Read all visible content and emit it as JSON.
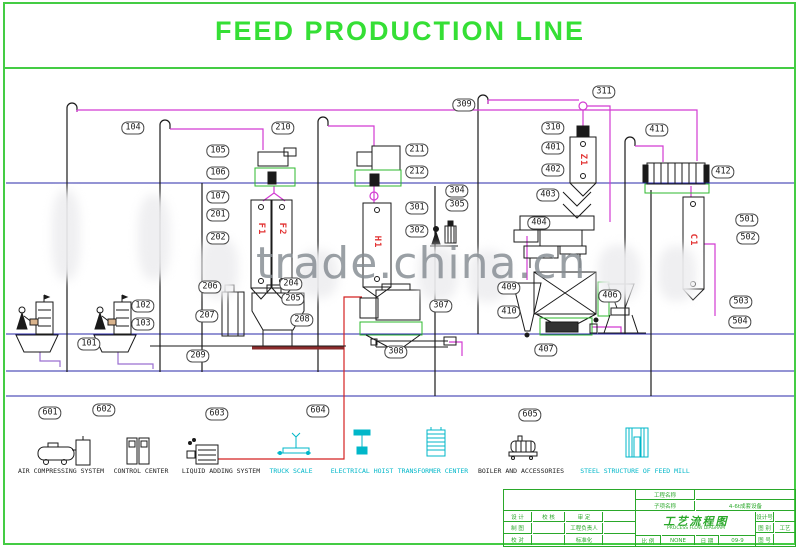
{
  "title": "FEED PRODUCTION LINE",
  "watermark": "trade.china.cn",
  "colors": {
    "border_green": "#44cc44",
    "equipment_green": "#2db82d",
    "flow_magenta": "#d23bd2",
    "liquid_red": "#d42222",
    "floor_navy": "#2a2aa8",
    "cyan_items": "#00b7c9",
    "bin_tag_red": "#e23434",
    "title_green": "#35df35",
    "titleblock_green": "#2aa82a"
  },
  "labels": [
    {
      "t": "101",
      "x": 89,
      "y": 344
    },
    {
      "t": "102",
      "x": 143,
      "y": 306
    },
    {
      "t": "103",
      "x": 143,
      "y": 324
    },
    {
      "t": "104",
      "x": 133,
      "y": 128
    },
    {
      "t": "105",
      "x": 218,
      "y": 151
    },
    {
      "t": "106",
      "x": 218,
      "y": 173
    },
    {
      "t": "107",
      "x": 218,
      "y": 197
    },
    {
      "t": "201",
      "x": 218,
      "y": 215
    },
    {
      "t": "202",
      "x": 218,
      "y": 238
    },
    {
      "t": "204",
      "x": 291,
      "y": 284
    },
    {
      "t": "205",
      "x": 293,
      "y": 299
    },
    {
      "t": "206",
      "x": 210,
      "y": 287
    },
    {
      "t": "207",
      "x": 207,
      "y": 316
    },
    {
      "t": "208",
      "x": 302,
      "y": 320
    },
    {
      "t": "209",
      "x": 198,
      "y": 356
    },
    {
      "t": "210",
      "x": 283,
      "y": 128
    },
    {
      "t": "211",
      "x": 417,
      "y": 150
    },
    {
      "t": "212",
      "x": 417,
      "y": 172
    },
    {
      "t": "301",
      "x": 417,
      "y": 208
    },
    {
      "t": "302",
      "x": 417,
      "y": 231
    },
    {
      "t": "304",
      "x": 457,
      "y": 191
    },
    {
      "t": "305",
      "x": 457,
      "y": 205
    },
    {
      "t": "307",
      "x": 441,
      "y": 306
    },
    {
      "t": "308",
      "x": 396,
      "y": 352
    },
    {
      "t": "309",
      "x": 464,
      "y": 105
    },
    {
      "t": "310",
      "x": 553,
      "y": 128
    },
    {
      "t": "311",
      "x": 604,
      "y": 92
    },
    {
      "t": "401",
      "x": 553,
      "y": 148
    },
    {
      "t": "402",
      "x": 553,
      "y": 170
    },
    {
      "t": "403",
      "x": 548,
      "y": 195
    },
    {
      "t": "404",
      "x": 539,
      "y": 223
    },
    {
      "t": "406",
      "x": 610,
      "y": 296
    },
    {
      "t": "407",
      "x": 546,
      "y": 350
    },
    {
      "t": "409",
      "x": 509,
      "y": 288
    },
    {
      "t": "410",
      "x": 509,
      "y": 312
    },
    {
      "t": "411",
      "x": 657,
      "y": 130
    },
    {
      "t": "412",
      "x": 723,
      "y": 172
    },
    {
      "t": "501",
      "x": 747,
      "y": 220
    },
    {
      "t": "502",
      "x": 748,
      "y": 238
    },
    {
      "t": "503",
      "x": 741,
      "y": 302
    },
    {
      "t": "504",
      "x": 740,
      "y": 322
    },
    {
      "t": "601",
      "x": 50,
      "y": 413
    },
    {
      "t": "602",
      "x": 104,
      "y": 410
    },
    {
      "t": "603",
      "x": 217,
      "y": 414
    },
    {
      "t": "604",
      "x": 318,
      "y": 411
    },
    {
      "t": "605",
      "x": 530,
      "y": 415
    }
  ],
  "bin_tags": [
    {
      "t": "F1",
      "x": 261,
      "y": 229
    },
    {
      "t": "F2",
      "x": 282,
      "y": 229
    },
    {
      "t": "H1",
      "x": 377,
      "y": 242
    },
    {
      "t": "Z1",
      "x": 583,
      "y": 160
    },
    {
      "t": "C1",
      "x": 693,
      "y": 240
    }
  ],
  "bottom_row": [
    {
      "name": "AIR COMPRESSING SYSTEM",
      "x": 61,
      "cyan": false
    },
    {
      "name": "CONTROL CENTER",
      "x": 141,
      "cyan": false
    },
    {
      "name": "LIQUID ADDING SYSTEM",
      "x": 221,
      "cyan": false
    },
    {
      "name": "TRUCK SCALE",
      "x": 291,
      "cyan": true
    },
    {
      "name": "ELECTRICAL HOIST",
      "x": 362,
      "cyan": true
    },
    {
      "name": "TRANSFORMER CENTER",
      "x": 433,
      "cyan": true
    },
    {
      "name": "BOILER AND ACCESSORIES",
      "x": 521,
      "cyan": false
    },
    {
      "name": "STEEL STRUCTURE OF FEED MILL",
      "x": 635,
      "cyan": true
    }
  ],
  "title_block": {
    "project_label": "工程名称",
    "project_value": "",
    "subitem_label": "子项名称",
    "subitem_value": "4-6t成套设备",
    "sign_rows": [
      [
        "设 计",
        "校 核",
        "审 定",
        ""
      ],
      [
        "制 图",
        "",
        "工程负责人",
        ""
      ],
      [
        "校 对",
        "",
        "标准化",
        ""
      ]
    ],
    "drawing_title_cn": "工艺流程图",
    "drawing_title_en": "PROCESS FLOW DIAGRAM",
    "scale_label": "比 例",
    "scale_value": "NONE",
    "date_label": "日 期",
    "date_value": "09-9",
    "design_no_label": "设计号",
    "design_no_value": "",
    "category_label": "图 别",
    "category_value": "工艺",
    "sheet_no_label": "图 号",
    "sheet_no_value": ""
  }
}
